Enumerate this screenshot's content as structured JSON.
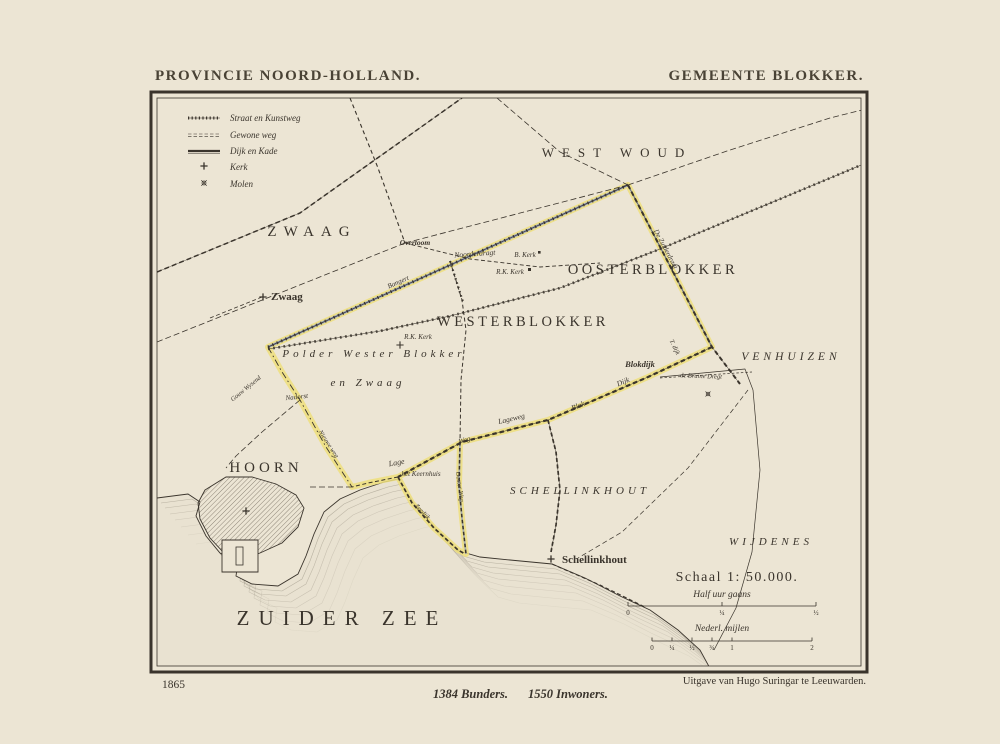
{
  "colors": {
    "paper": "#ece5d4",
    "ink": "#3a342c",
    "title-ink": "#494235",
    "yellow": "#eedf7b",
    "blue": "#96a2c0",
    "hatch": "#766e60",
    "water": "#7d7567",
    "sea-fill": "#e9e2d1"
  },
  "header": {
    "title_left": "PROVINCIE NOORD-HOLLAND.",
    "title_right": "GEMEENTE BLOKKER."
  },
  "legend": {
    "items": [
      {
        "label": "Straat en Kunstweg"
      },
      {
        "label": "Gewone weg"
      },
      {
        "label": "Dijk en Kade"
      },
      {
        "label": "Kerk"
      },
      {
        "label": "Molen"
      }
    ]
  },
  "map": {
    "regions": {
      "zwaag": "ZWAAG",
      "westwoud": "WEST WOUD",
      "oosterblokker": "OOSTERBLOKKER",
      "westerblokker": "WESTERBLOKKER",
      "venhuizen": "VENHUIZEN",
      "schellinkhout": "SCHELLINKHOUT",
      "wijdenes": "WIJDENES",
      "hoorn": "HOORN",
      "zuiderzee": "ZUIDER ZEE"
    },
    "polder": {
      "line1": "Polder Wester Blokker",
      "line2": "en Zwaag"
    },
    "places": {
      "zwaag": "Zwaag",
      "overtoom": "Overtoom",
      "schellinkhout": "Schellinkhout",
      "blokdijk": "Blokdijk",
      "bkerk": "B. Kerk",
      "rkkerk_east": "R.K. Kerk",
      "rkkerk_west": "R.K. Kerk"
    },
    "roads": {
      "noorderdragt": "Noorderdragt",
      "bangert": "Bangert",
      "nadorst": "Nadorst",
      "lage": "Lage",
      "keernhuis": "het Keernhuis",
      "lageweg": "Lageweg",
      "weg": "Weg",
      "blok": "Blok",
      "dijk": "Dijk",
      "tdijk": "T. dijk",
      "bruine_dregt": "de Bruine Dregt",
      "zuiderdragt": "De Zuiderdragt",
      "nieuwe_weg": "Nieuwe weg",
      "gouw_wysend": "Gouw Wysend",
      "ooster_weg": "Ooster Weg",
      "zeedijk": "Zeedijk"
    }
  },
  "scale": {
    "title": "Schaal 1: 50.000.",
    "walking": {
      "label": "Half uur gaans",
      "ticks": [
        "0",
        "¼",
        "½"
      ]
    },
    "miles": {
      "label": "Nederl. mijlen",
      "ticks": [
        "0",
        "¼",
        "½",
        "¾",
        "1",
        "2"
      ]
    }
  },
  "footer": {
    "year": "1865",
    "publisher": "Uitgave van Hugo Suringar te Leeuwarden.",
    "area": "1384 Bunders.",
    "population": "1550 Inwoners."
  }
}
